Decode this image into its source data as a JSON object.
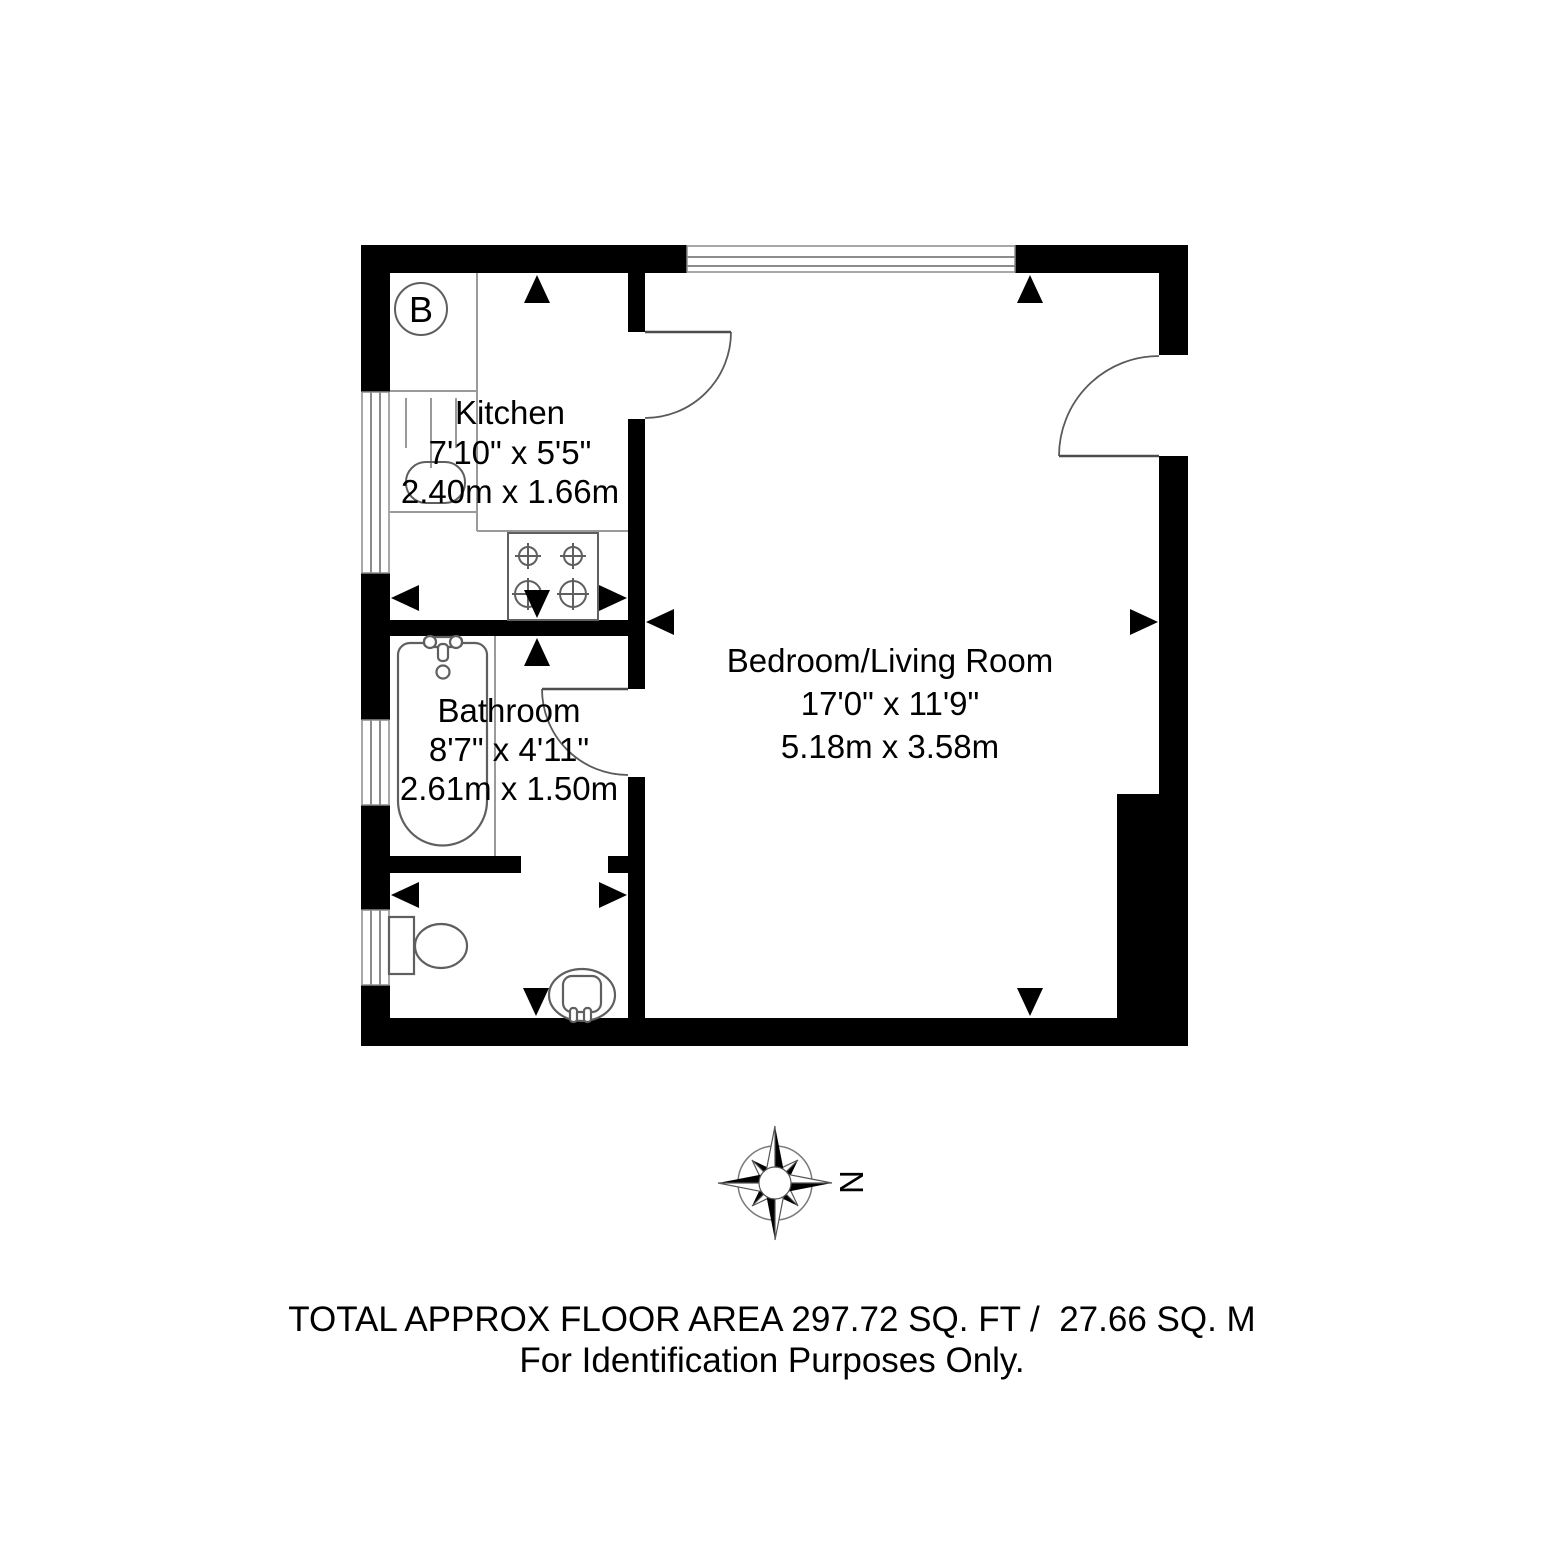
{
  "plan": {
    "boiler_label": "B",
    "rooms": {
      "kitchen": {
        "name": "Kitchen",
        "imperial": "7'10\" x 5'5\"",
        "metric": "2.40m x 1.66m"
      },
      "bathroom": {
        "name": "Bathroom",
        "imperial": "8'7\" x 4'11\"",
        "metric": "2.61m x 1.50m"
      },
      "bedroom": {
        "name": "Bedroom/Living Room",
        "imperial": "17'0\" x 11'9\"",
        "metric": "5.18m x 3.58m"
      }
    },
    "compass": {
      "north_label": "N"
    }
  },
  "footer": {
    "line1": "TOTAL APPROX FLOOR AREA 297.72 SQ. FT /  27.66 SQ. M",
    "line2": "For Identification Purposes Only."
  },
  "colors": {
    "wall": "#000000",
    "fixture_stroke": "#5f5f5f",
    "counter_stroke": "#9a9a9a",
    "window_stroke": "#8c8c8c",
    "text": "#000000",
    "background": "#ffffff"
  }
}
